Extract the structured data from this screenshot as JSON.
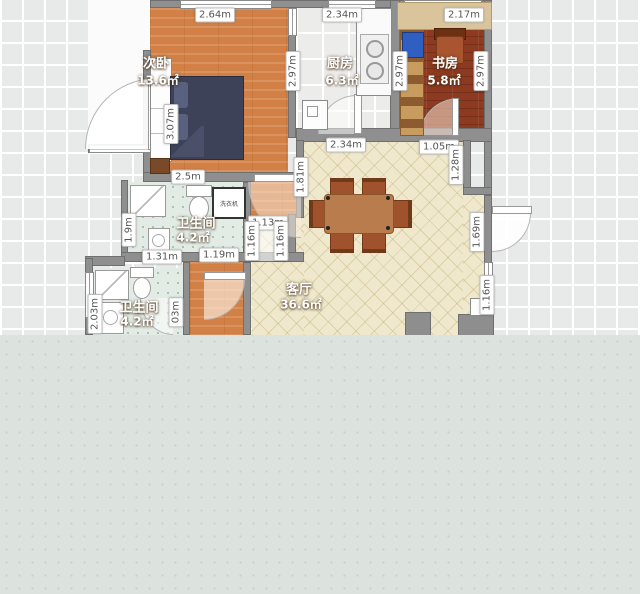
{
  "rooms": {
    "bedroom": {
      "name": "次卧",
      "area": "13.6㎡"
    },
    "kitchen": {
      "name": "厨房",
      "area": "6.3㎡"
    },
    "study": {
      "name": "书房",
      "area": "5.8㎡"
    },
    "bath1": {
      "name": "卫生间",
      "area": "4.2㎡"
    },
    "bath2": {
      "name": "卫生间",
      "area": "4.2㎡"
    },
    "living": {
      "name": "客厅",
      "area": "36.6㎡"
    }
  },
  "labels": {
    "washer": "洗衣机"
  },
  "dims": {
    "bedroom_width": "2.64m",
    "bedroom_right": "2.97m",
    "bedroom_left": "3.07m",
    "bedroom_bottom": "2.5m",
    "kitchen_width": "2.34m",
    "kitchen_right": "2.97m",
    "study_width": "2.17m",
    "study_right": "2.97m",
    "bath1_left": "1.9m",
    "bath1_bottom_a": "1.31m",
    "bath1_bottom_b": "1.19m",
    "alcove_width": "1.13m",
    "alcove_left": "1.16m",
    "alcove_right": "1.16m",
    "living_left": "1.81m",
    "living_top": "2.34m",
    "entry_top": "1.05m",
    "entry_step": "1.28m",
    "entry_door": "1.69m",
    "living_right_lower": "1.16m",
    "bath2_left": "2.03m",
    "bath2_right": "03m"
  },
  "colors": {
    "wall": "#8f8f8f",
    "bedroom_floor": "#d28045",
    "study_floor": "#8e3a20",
    "living_floor": "#efe8cc",
    "bath_floor": "#e2ece5",
    "kitchen_floor": "#ececea",
    "bed": "#3d4258",
    "table": "#b97c4c",
    "overlay": "#dce3de"
  }
}
